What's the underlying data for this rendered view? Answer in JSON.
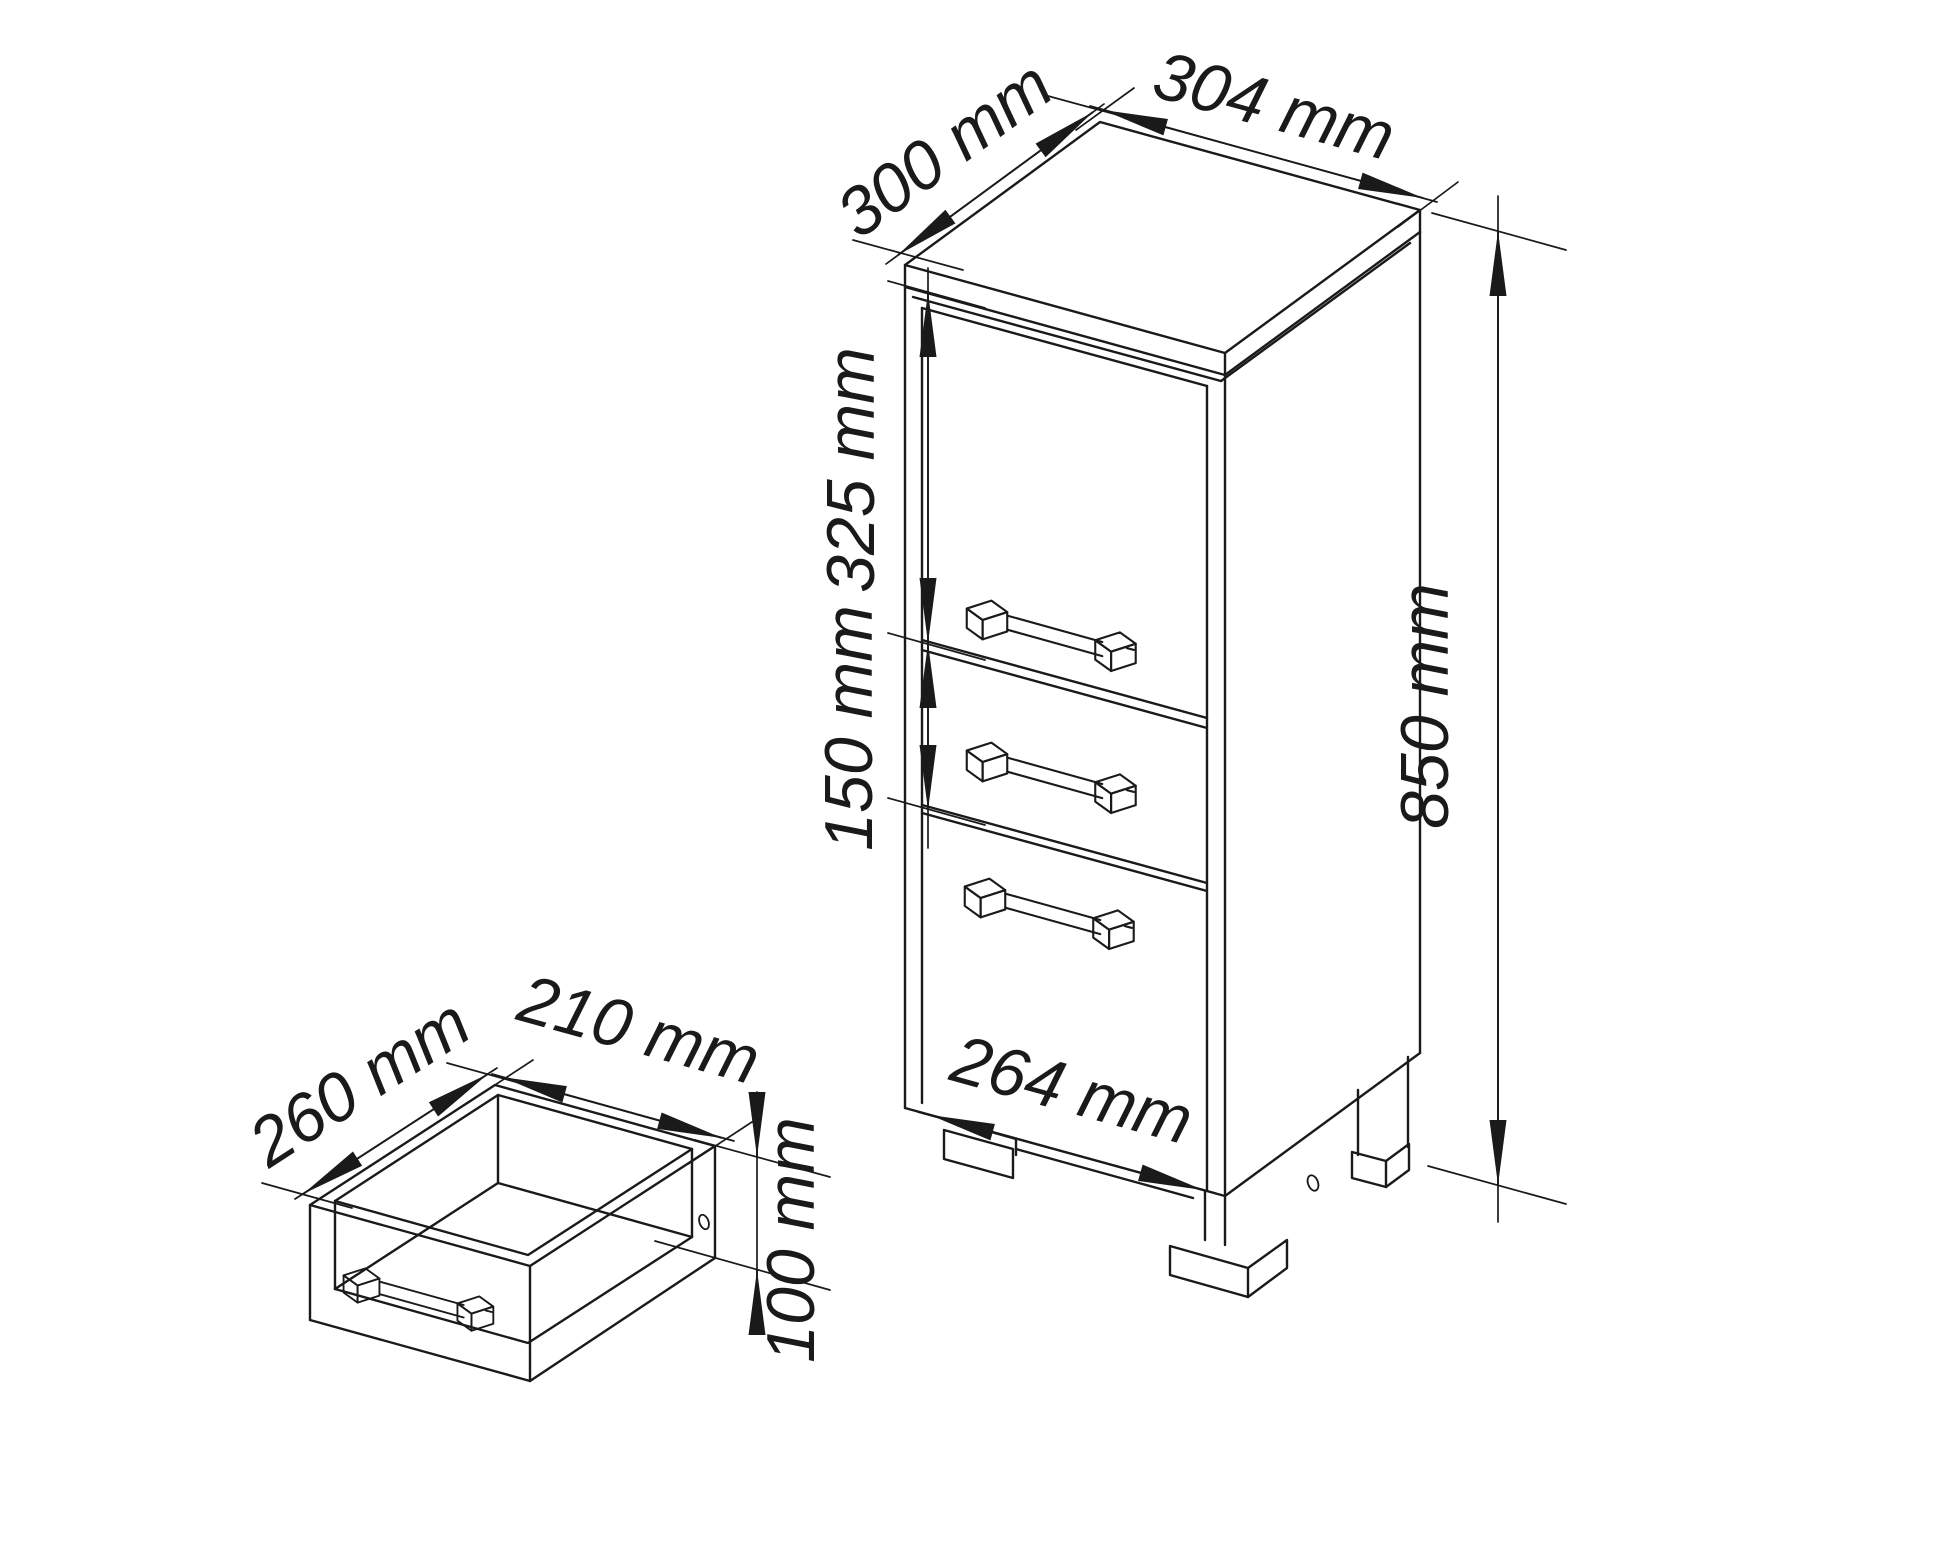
{
  "drawing": {
    "kind": "furniture-dimensional-line-drawing",
    "background": "#ffffff",
    "line_color": "#1a1a1a",
    "cabinet": {
      "top_depth_label": "300 mm",
      "top_width_label": "304 mm",
      "door_height_label": "325 mm",
      "drawer_height_label": "150 mm",
      "total_height_label": "850 mm",
      "front_width_label": "264 mm"
    },
    "drawer_detail": {
      "depth_label": "260 mm",
      "width_label": "210 mm",
      "height_label": "100 mm"
    }
  }
}
